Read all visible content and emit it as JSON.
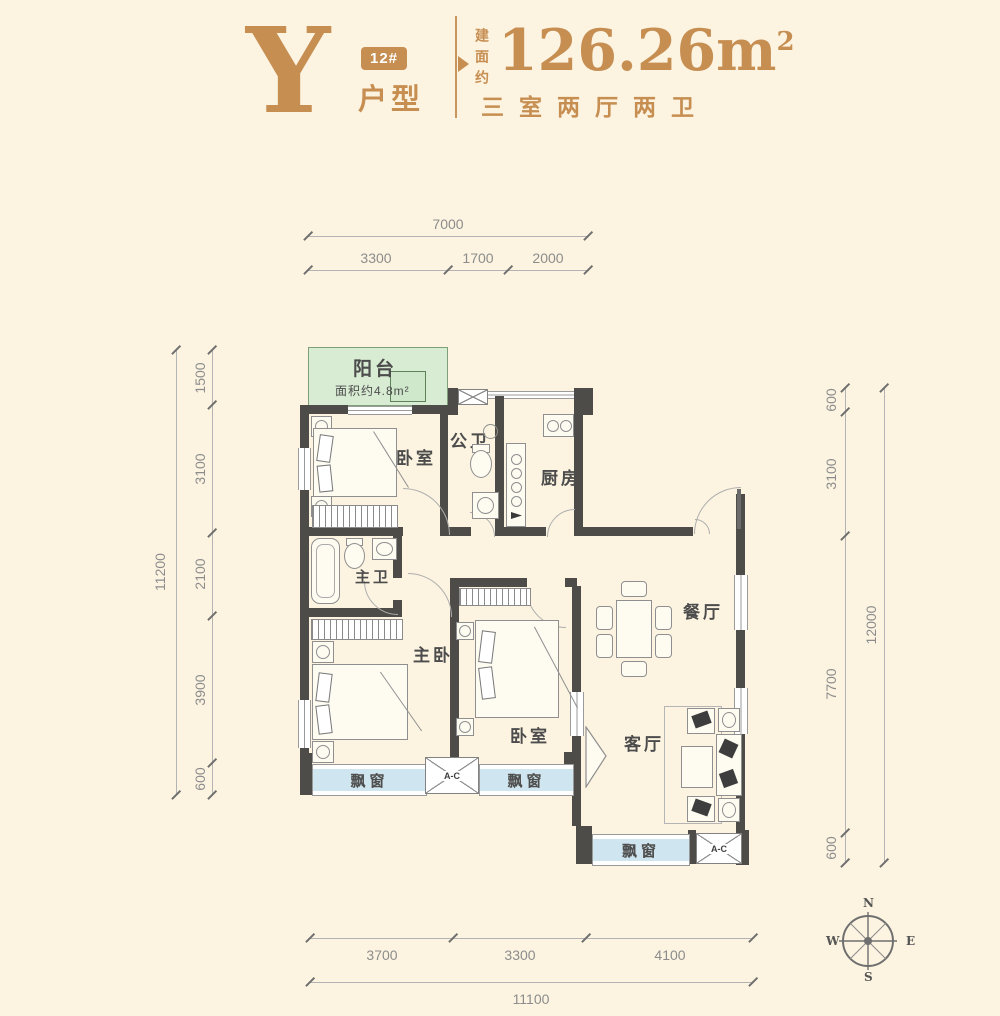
{
  "header": {
    "type_letter": "Y",
    "building_badge": "12#",
    "type_label": "户型",
    "area_prefix": "建面约",
    "area_value": "126.26m",
    "area_sup": "2",
    "layout_text": "三室两厅两卫"
  },
  "rooms": {
    "balcony": "阳台",
    "balcony_area": "面积约4.8m²",
    "bedroom": "卧室",
    "public_bath": "公卫",
    "kitchen": "厨房",
    "master_bath": "主卫",
    "master_bedroom": "主卧",
    "dining": "餐厅",
    "living": "客厅",
    "bay_window": "飘窗",
    "ac_unit": "A-C"
  },
  "dims": {
    "top": {
      "total": "7000",
      "segments": [
        "3300",
        "1700",
        "2000"
      ]
    },
    "left": {
      "total": "11200",
      "segments": [
        "1500",
        "3100",
        "2100",
        "3900",
        "600"
      ]
    },
    "right": {
      "total": "12000",
      "segments": [
        "600",
        "3100",
        "7700",
        "600"
      ]
    },
    "bottom": {
      "total": "11100",
      "segments": [
        "3700",
        "3300",
        "4100"
      ]
    }
  },
  "compass": {
    "n": "N",
    "e": "E",
    "s": "S",
    "w": "W"
  },
  "colors": {
    "accent_orange": "#c78e52",
    "wall": "#4e4c49",
    "bay_blue": "#cfe5ef",
    "balcony_green": "#d8ebd3"
  }
}
